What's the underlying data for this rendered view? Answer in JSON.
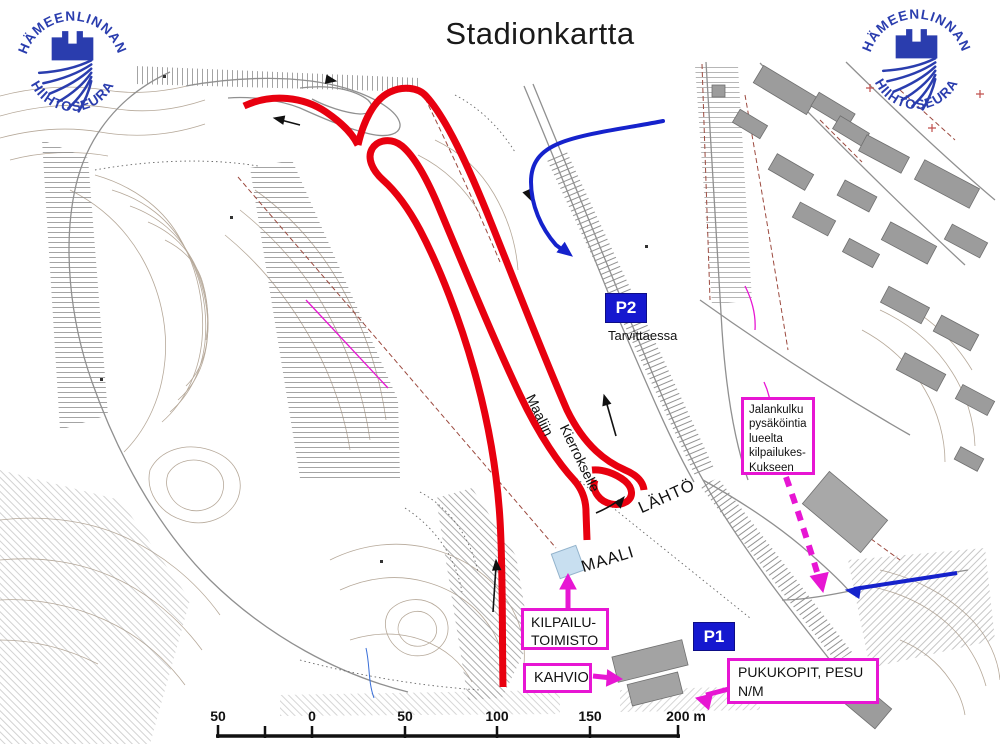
{
  "title": "Stadionkartta",
  "logo": {
    "top_text": "HÄMEENLINNAN",
    "bottom_text": "HIIHTOSEURA"
  },
  "map": {
    "p2_label": "P2",
    "p1_label": "P1",
    "labels": {
      "tarvittaessa": "Tarvittaessa",
      "maaliin": "Maaliin",
      "kierrokselle": "Kierrokselle",
      "lahto": "LÄHTÖ",
      "maali": "MAALI"
    },
    "callouts": {
      "jalankulku": "Jalankulku\npysäköintia\nlueelta\nkilpailukes-\nKukseen",
      "kilpailutoimisto": "KILPAILU-\nTOIMISTO",
      "kahvio": "KAHVIO",
      "pukukopit": "PUKUKOPIT, PESU\nN/M"
    }
  },
  "scale_bar": {
    "labels": [
      "50",
      "0",
      "50",
      "100",
      "150",
      "200 m"
    ],
    "unit": "m"
  },
  "colors": {
    "route_red": "#e8000f",
    "direction_blue": "#1522cc",
    "highlight_magenta": "#e716d3",
    "parking_blue": "#1518cf",
    "logo_blue": "#2a3dae",
    "contour_brown": "#b2a494",
    "building_grey": "#9c9c9c"
  }
}
